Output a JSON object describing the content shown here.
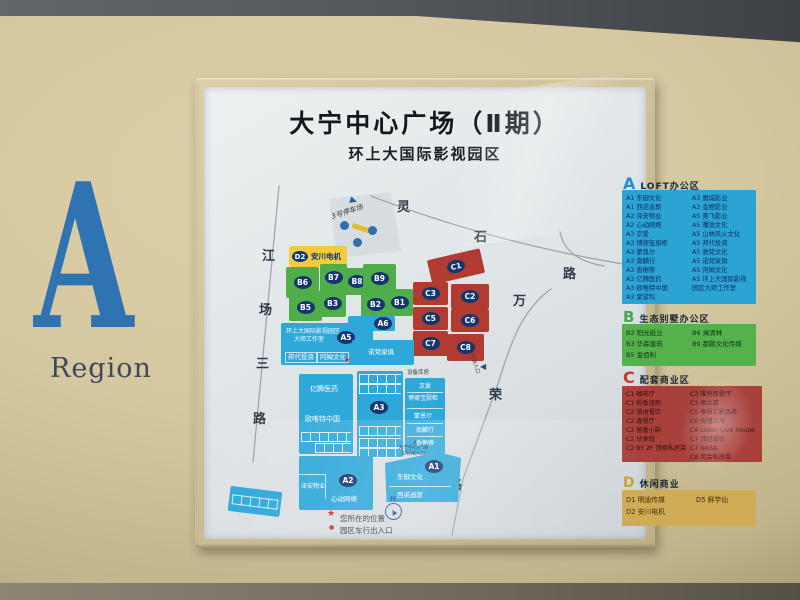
{
  "region": {
    "letter": "A",
    "label": "Region"
  },
  "panel": {
    "title": "大宁中心广场（Ⅱ期）",
    "subtitle": "环上大国际影视园区",
    "legends": {
      "A": {
        "letter": "A",
        "title": "LOFT办公区",
        "color": "#2ba3d3",
        "col1": [
          "A1 东御文化",
          "A1 西诺迪斯",
          "A2 泽安物业",
          "A2 心动网络",
          "A3 京爱",
          "A3 博德宝厨柜",
          "A3 蒙恩尔",
          "A3 南麟行",
          "A3 香榭蒂",
          "A3 亿腾医药",
          "A3 欧唯特中国",
          "A3 紫望坞"
        ],
        "col2": [
          "A3 魔城影业",
          "A3 金橙影业",
          "A5 奥飞影业",
          "A5 曙浪文化",
          "A5 山林风火文化",
          "A5 邦代投资",
          "A5 雅梵文化",
          "A5 诺梵家俱",
          "A5 阿姆文化",
          "A5 环上大国际影视",
          "园区大师工作室"
        ]
      },
      "B": {
        "letter": "B",
        "title": "生态别墅办公区",
        "color": "#55b14c",
        "col1": [
          "B2 阳光纸业",
          "B3 华森建筑",
          "B5 金佰利"
        ],
        "col2": [
          "B6 澜清林",
          "B9 都鹏文化传媒"
        ]
      },
      "C": {
        "letter": "C",
        "title": "配套商业区",
        "color": "#a8403c",
        "col1": [
          "C1 咖啡厅",
          "C1 焖香迷踪",
          "C2 漫途餐饮",
          "C2 鑫餐厅",
          "C2 留香小厨",
          "C2 伙食班",
          "C2 BY 2F 顶级私房菜"
        ],
        "col2": [
          "C3 唯利西餐厅",
          "C3 格兰慕",
          "C5 泰熹汇影品荟",
          "C6 悦瑾江河",
          "C6 Listen Live House",
          "C7 顶冠餐饮",
          "C7 NASA",
          "C8 玥会私房菜"
        ]
      },
      "D": {
        "letter": "D",
        "title": "休闲商业",
        "color": "#cfab55",
        "col1": [
          "D1 明迪传媒",
          "D2 安川电机"
        ],
        "col2": [
          "D5 鲜芋仙"
        ]
      }
    },
    "map": {
      "streets": {
        "jiangchang": [
          "江",
          "场",
          "三",
          "路"
        ],
        "lingshi": [
          "灵",
          "石",
          "路"
        ],
        "wanrong": [
          "万",
          "荣",
          "路"
        ]
      },
      "parking_label": "3号停车场",
      "block_labels": {
        "b1": "B1",
        "b2": "B2",
        "b3": "B3",
        "b5": "B5",
        "b6": "B6",
        "b7": "B7",
        "b8": "B8",
        "b9": "B9",
        "c1": "C1",
        "c2": "C2",
        "c3": "C3",
        "c5": "C5",
        "c6": "C6",
        "c7": "C7",
        "c8": "C8",
        "a1": "A1",
        "a2": "A2",
        "a3": "A3",
        "a5": "A5",
        "a6": "A6",
        "d2": "D2"
      },
      "d2_name": "安川电机",
      "a5": {
        "line1": "环上大国际影视园区",
        "line2": "大师工作室",
        "cell1": "邦代投资",
        "cell2": "阿姆文化",
        "cell3": "诺梵家俱"
      },
      "a3": {
        "top": "设备库房",
        "left1": "亿腾医药",
        "left2": "欧唯特中国",
        "r1": "京爱",
        "r2": "博德宝厨柜",
        "r3": "蒙恩尔",
        "r4": "南麟行",
        "r5": "香榭蒂"
      },
      "a2": {
        "c1": "泽安物业",
        "c2": "心动网络"
      },
      "a1": {
        "c1": "东御文化",
        "c2": "西诺迪斯"
      },
      "entrance_caption_line1": "大宁中心广场",
      "entrance_caption_line2": "车行出入口",
      "side_entrance_label": "车行出入口",
      "compass": "N",
      "marker_legend": "您所在的位置",
      "entrance_legend": "园区车行出入口"
    },
    "colors": {
      "block_blue": "#2ea8d9",
      "block_green": "#4fae49",
      "block_red": "#b23b31",
      "oval_navy": "#14366e",
      "d2_gold": "#f2cb3e",
      "region_blue": "#2f73b2",
      "board_beige": "#d5c8a0",
      "marker_red": "#d6281c"
    }
  }
}
